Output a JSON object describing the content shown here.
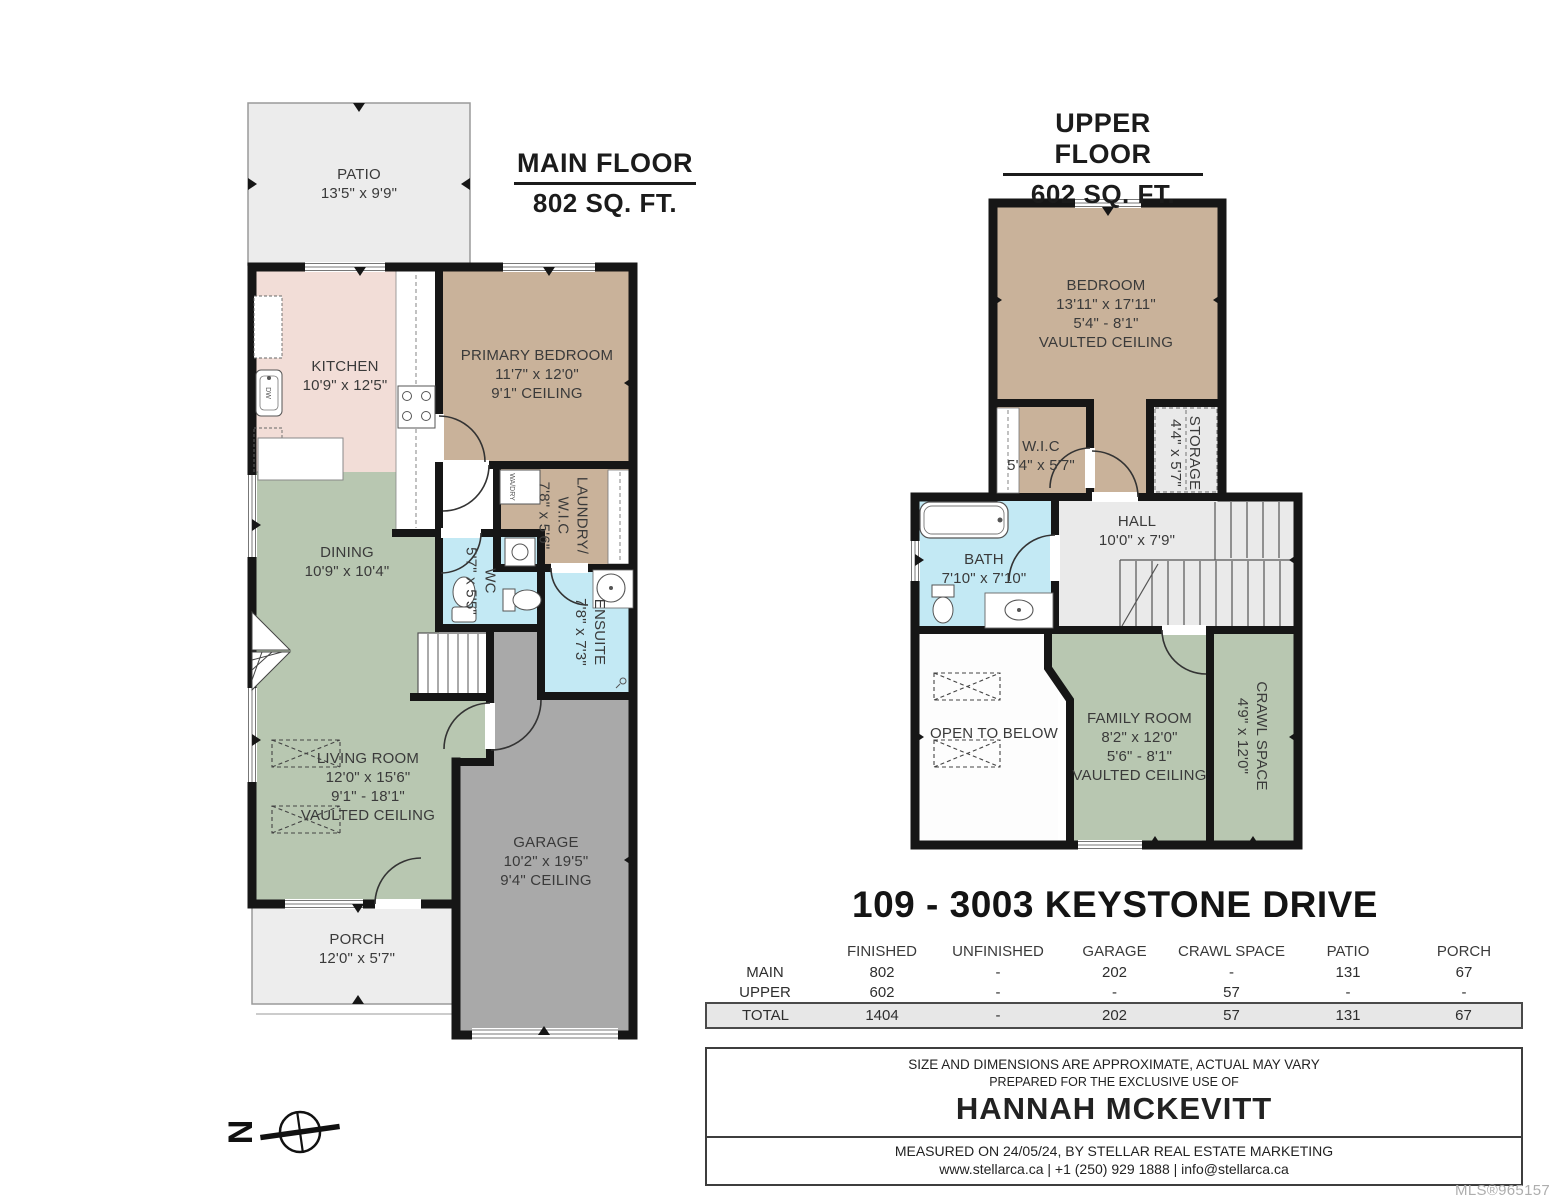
{
  "main_floor": {
    "title": "MAIN FLOOR",
    "subtitle": "802 SQ. FT.",
    "rooms": [
      {
        "lines": [
          "PATIO",
          "13'5\" x 9'9\""
        ]
      },
      {
        "lines": [
          "KITCHEN",
          "10'9\" x 12'5\""
        ]
      },
      {
        "lines": [
          "PRIMARY BEDROOM",
          "11'7\" x 12'0\"",
          "9'1\" CEILING"
        ]
      },
      {
        "lines": [
          "LAUNDRY/",
          "W.I.C",
          "7'8\" x 5'6\""
        ]
      },
      {
        "lines": [
          "WC",
          "5'7\" x 5'5\""
        ]
      },
      {
        "lines": [
          "ENSUITE",
          "7'8\" x 7'3\""
        ]
      },
      {
        "lines": [
          "DINING",
          "10'9\" x 10'4\""
        ]
      },
      {
        "lines": [
          "LIVING ROOM",
          "12'0\" x 15'6\"",
          "9'1\" - 18'1\"",
          "VAULTED CEILING"
        ]
      },
      {
        "lines": [
          "GARAGE",
          "10'2\" x 19'5\"",
          "9'4\" CEILING"
        ]
      },
      {
        "lines": [
          "PORCH",
          "12'0\" x 5'7\""
        ]
      }
    ]
  },
  "upper_floor": {
    "title": "UPPER FLOOR",
    "subtitle": "602 SQ. FT.",
    "rooms": [
      {
        "lines": [
          "BEDROOM",
          "13'11\" x 17'11\"",
          "5'4\" - 8'1\"",
          "VAULTED CEILING"
        ]
      },
      {
        "lines": [
          "W.I.C",
          "5'4\" x 5'7\""
        ]
      },
      {
        "lines": [
          "STORAGE",
          "4'4\" x 5'7\""
        ]
      },
      {
        "lines": [
          "BATH",
          "7'10\" x 7'10\""
        ]
      },
      {
        "lines": [
          "HALL",
          "10'0\" x 7'9\""
        ]
      },
      {
        "lines": [
          "OPEN TO BELOW"
        ]
      },
      {
        "lines": [
          "FAMILY ROOM",
          "8'2\" x 12'0\"",
          "5'6\" - 8'1\"",
          "VAULTED CEILING"
        ]
      },
      {
        "lines": [
          "CRAWL SPACE",
          "4'9\" x 12'0\""
        ]
      }
    ]
  },
  "fixtures": {
    "washer": "WA/DRY",
    "dishwasher": "DW"
  },
  "address": "109 - 3003 KEYSTONE DRIVE",
  "table": {
    "headers": [
      "FINISHED",
      "UNFINISHED",
      "GARAGE",
      "CRAWL SPACE",
      "PATIO",
      "PORCH"
    ],
    "rows": [
      {
        "label": "MAIN",
        "values": [
          "802",
          "-",
          "202",
          "-",
          "131",
          "67"
        ]
      },
      {
        "label": "UPPER",
        "values": [
          "602",
          "-",
          "-",
          "57",
          "-",
          "-"
        ]
      },
      {
        "label": "TOTAL",
        "values": [
          "1404",
          "-",
          "202",
          "57",
          "131",
          "67"
        ]
      }
    ]
  },
  "footer": {
    "disclaimer": "SIZE AND DIMENSIONS ARE APPROXIMATE, ACTUAL MAY VARY",
    "prepared": "PREPARED FOR THE EXCLUSIVE USE OF",
    "client": "HANNAH MCKEVITT",
    "measured": "MEASURED ON 24/05/24, BY STELLAR REAL ESTATE MARKETING",
    "contact": "www.stellarca.ca | +1 (250) 929 1888 | info@stellarca.ca"
  },
  "mls": "MLS®965157",
  "compass": {
    "letter": "N"
  },
  "colors": {
    "wall": "#161616",
    "kitchen": "#f2ddd7",
    "bedroom_tan": "#c9b29a",
    "living_green": "#b8c7b1",
    "bath_blue": "#c3e9f4",
    "garage_gray": "#a9a9a9",
    "outdoor_gray": "#ececec",
    "hall_gray": "#e9e9e9",
    "total_row_bg": "#e7e7e7"
  }
}
